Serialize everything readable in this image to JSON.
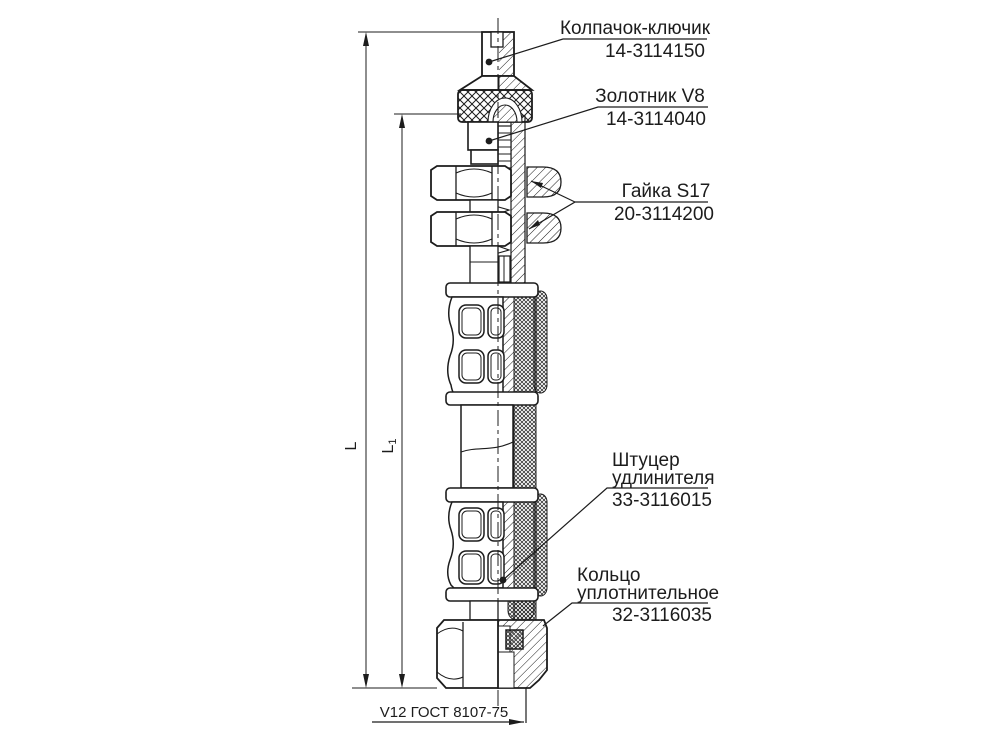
{
  "callouts": {
    "cap": {
      "name": "Колпачок-ключик",
      "number": "14-3114150"
    },
    "valve_core": {
      "name": "Золотник V8",
      "number": "14-3114040"
    },
    "nut": {
      "name": "Гайка S17",
      "number": "20-3114200"
    },
    "extension_fitting": {
      "name_line1": "Штуцер",
      "name_line2": "удлинителя",
      "number": "33-3116015"
    },
    "sealing_ring": {
      "name_line1": "Кольцо",
      "name_line2": "уплотнительное",
      "number": "32-3116035"
    }
  },
  "footer": {
    "valve_standard": "V12 ГОСТ 8107-75"
  },
  "dimensions": {
    "overall": "L",
    "partial": "L",
    "partial_index": "1"
  },
  "colors": {
    "line": "#1c1c1c",
    "background": "#ffffff"
  }
}
